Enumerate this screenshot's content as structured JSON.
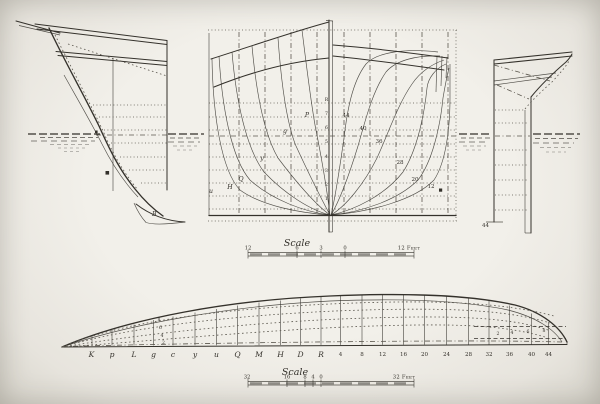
{
  "colors": {
    "paper": "#edebe5",
    "ink": "#34312b"
  },
  "bow_profile": {
    "forefoot_label": "B"
  },
  "body_plan": {
    "left_curve_labels": [
      "P",
      "g",
      "y",
      "Q",
      "H",
      "u"
    ],
    "right_curve_labels": [
      "44",
      "40",
      "36",
      "28",
      "20",
      "12"
    ],
    "centerline_labels": [
      "R",
      "7",
      "6",
      "5",
      "4",
      "3",
      "2",
      "1"
    ]
  },
  "stern_profile": {
    "base_label": "44"
  },
  "mid_scale": {
    "title": "Scale",
    "tick_labels": [
      "12",
      "6",
      "3",
      "0"
    ],
    "end_label": "12 Feet"
  },
  "half_breadth": {
    "station_labels": [
      "K",
      "p",
      "L",
      "g",
      "c",
      "y",
      "u",
      "Q",
      "M",
      "H",
      "D",
      "R",
      "4",
      "8",
      "12",
      "16",
      "20",
      "24",
      "28",
      "32",
      "36",
      "40",
      "44"
    ],
    "left_diagonal_labels": [
      "8",
      "6",
      "4",
      "2"
    ],
    "right_diagonal_labels": [
      "2",
      "4",
      "6",
      "8"
    ]
  },
  "bottom_scale": {
    "title": "Scale",
    "tick_labels": [
      "32",
      "16",
      "8",
      "4",
      "0"
    ],
    "end_label": "32 Feet"
  }
}
